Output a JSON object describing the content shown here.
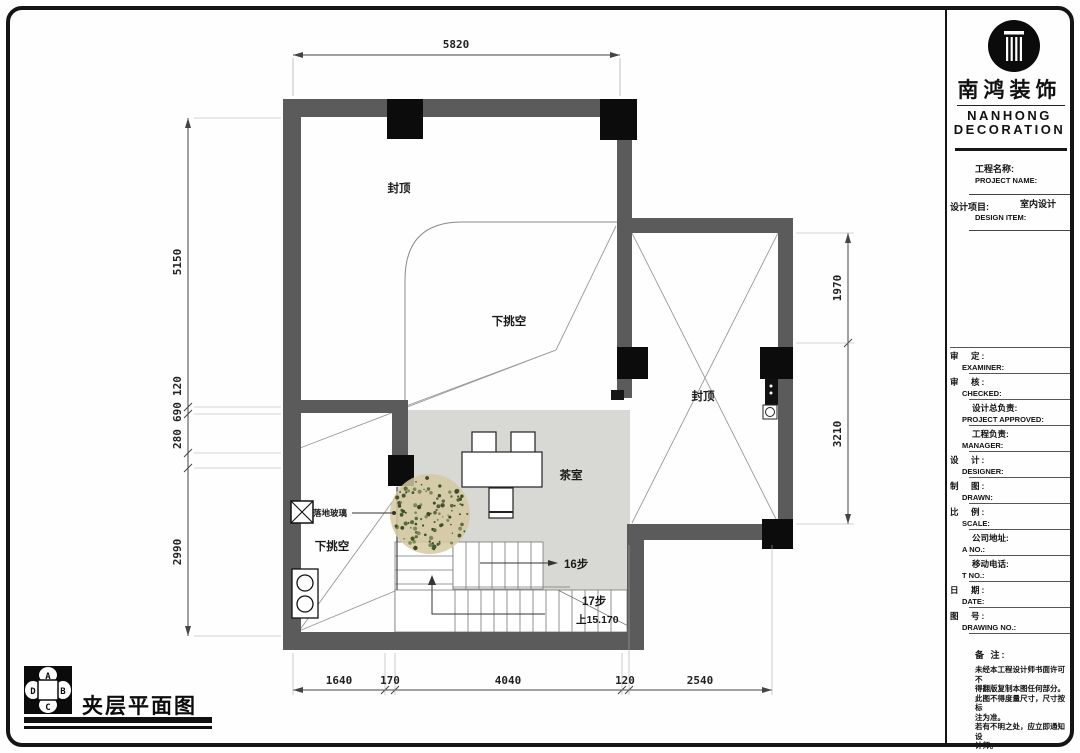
{
  "plan": {
    "title": "夹层平面图",
    "dims": {
      "top": "5820",
      "left": [
        "5150",
        "120",
        "690",
        "280",
        "2990"
      ],
      "right": [
        "1970",
        "3210"
      ],
      "bottom": [
        "1640",
        "170",
        "4040",
        "120",
        "2540"
      ]
    },
    "labels": {
      "roof_main": "封顶",
      "roof_right": "封顶",
      "void_upper": "下挑空",
      "void_lower": "下挑空",
      "tea_room": "茶室",
      "floor_glass": "落地玻璃",
      "steps_upper": "16步",
      "steps_lower": "17步",
      "elevation": "上15.170"
    },
    "compass": {
      "n": "A",
      "e": "B",
      "s": "C",
      "w": "D"
    },
    "colors": {
      "wall": "#5b5b5b",
      "column": "#0c0c0c",
      "floor": "#d8d8d4",
      "plant": "#d6c9a0"
    }
  },
  "titleblock": {
    "company_cn": "南鸿装饰",
    "company_en_line1": "NANHONG",
    "company_en_line2": "DECORATION",
    "project_name_cn": "工程名称:",
    "project_name_en": "PROJECT NAME:",
    "design_item_cn": "设计项目:",
    "design_item_value": "室内设计",
    "design_item_en": "DESIGN ITEM:",
    "rows": [
      {
        "cn": "审　定:",
        "en": "EXAMINER:"
      },
      {
        "cn": "审　核:",
        "en": "CHECKED:"
      },
      {
        "cn": "设计总负责:",
        "en": "PROJECT APPROVED:"
      },
      {
        "cn": "工程负责:",
        "en": "MANAGER:"
      },
      {
        "cn": "设　计:",
        "en": "DESIGNER:"
      },
      {
        "cn": "制　图:",
        "en": "DRAWN:"
      },
      {
        "cn": "比　例:",
        "en": "SCALE:"
      },
      {
        "cn": "公司地址:",
        "en": "A NO.:"
      },
      {
        "cn": "移动电话:",
        "en": "T NO.:"
      },
      {
        "cn": "日　期:",
        "en": "DATE:"
      },
      {
        "cn": "图　号:",
        "en": "DRAWING NO.:"
      }
    ],
    "notes_title": "备 注:",
    "notes_lines": [
      "未经本工程设计师书面许可不",
      "得翻版复制本图任何部分。",
      "此图不得度量尺寸，尺寸按标",
      "注为准。",
      "若有不明之处，应立即通知设",
      "计师。"
    ]
  }
}
